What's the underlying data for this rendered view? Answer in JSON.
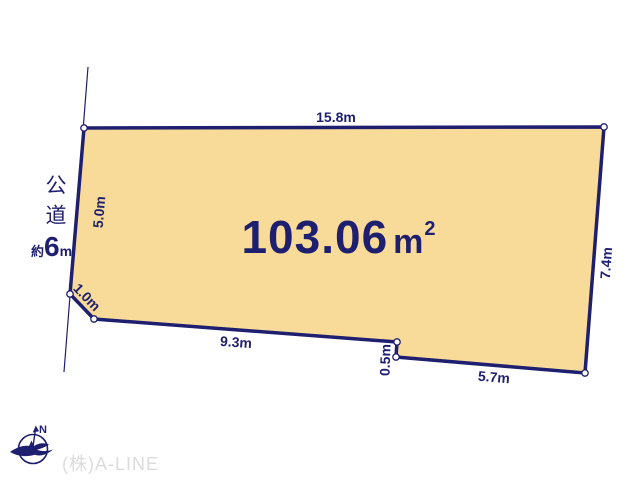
{
  "diagram": {
    "type": "land-plot-layout",
    "area": {
      "value": "103.06",
      "unit": "m",
      "unit_sup": "2"
    },
    "dimensions": [
      {
        "side": "top",
        "label": "15.8m"
      },
      {
        "side": "left",
        "label": "5.0m"
      },
      {
        "side": "corner-cut",
        "label": "1.0m"
      },
      {
        "side": "bottom-left",
        "label": "9.3m"
      },
      {
        "side": "notch",
        "label": "0.5m"
      },
      {
        "side": "bottom-right",
        "label": "5.7m"
      },
      {
        "side": "right",
        "label": "7.4m"
      }
    ],
    "road": {
      "name": "公道",
      "width_prefix": "約",
      "width_value": "6",
      "width_unit": "m"
    },
    "compass": {
      "north_label": "N"
    },
    "footer": {
      "company": "(株)A-LINE"
    },
    "colors": {
      "plot_fill": "#f8db99",
      "outline": "#1f1f70",
      "vertex_fill": "#ffffff",
      "company_text": "#dcdcdc"
    }
  }
}
